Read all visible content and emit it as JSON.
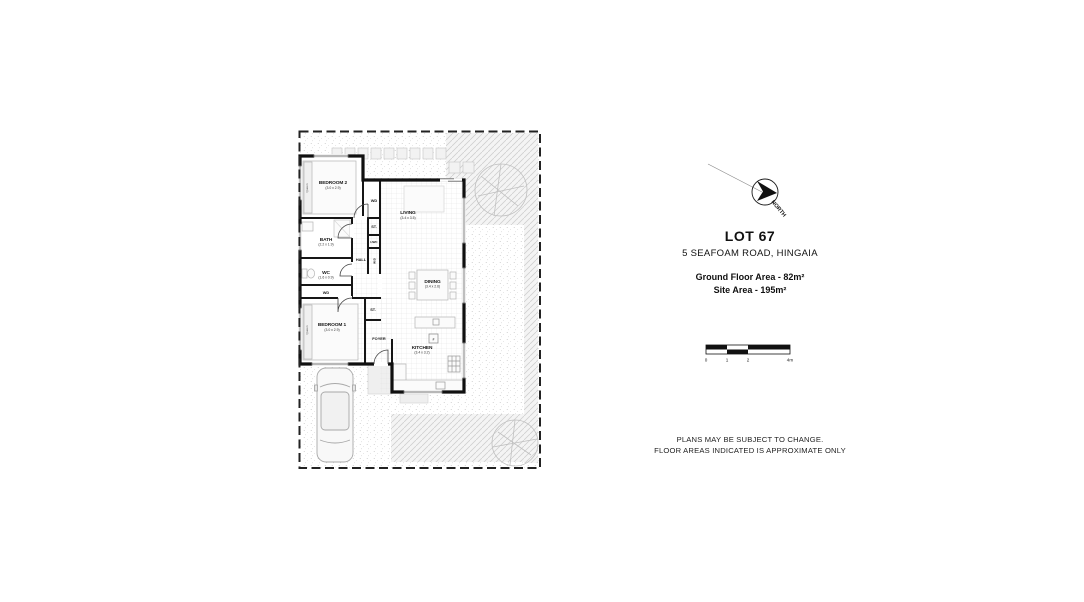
{
  "info_panel": {
    "lot_title": "LOT 67",
    "address": "5 SEAFOAM ROAD, HINGAIA",
    "ground_floor_area": "Ground Floor Area - 82m²",
    "site_area": "Site Area - 195m²",
    "disclaimer_line1": "PLANS MAY BE SUBJECT TO CHANGE.",
    "disclaimer_line2": "FLOOR AREAS INDICATED IS APPROXIMATE ONLY"
  },
  "north_arrow": {
    "label": "NORTH"
  },
  "scale_bar": {
    "t0": "0",
    "t1": "1",
    "t2": "2",
    "t3": "4m"
  },
  "floor_plan": {
    "bedroom2_name": "BEDROOM 2",
    "bedroom2_dims": "(3.0 x 2.9)",
    "bedroom1_name": "BEDROOM 1",
    "bedroom1_dims": "(3.0 x 2.9)",
    "living_name": "LIVING",
    "living_dims": "(3.4 x 3.5)",
    "dining_name": "DINING",
    "dining_dims": "(3.4 x 2.6)",
    "kitchen_name": "KITCHEN",
    "kitchen_dims": "(3.4 x 3.2)",
    "bath_name": "BATH",
    "bath_dims": "(2.2 x 1.9)",
    "wc_name": "WC",
    "wc_dims": "(1.6 x 0.9)",
    "hall_name": "HALL",
    "foyer_name": "FOYER",
    "wardrobe_top": "WD",
    "wardrobe_mid": "WD",
    "store_top": "ST.",
    "store_foyer": "ST.",
    "hwc": "HWC",
    "laundry": "W/D",
    "bed2_tag": "Queen",
    "bed1_tag": "Queen",
    "fridge": "F"
  },
  "colors": {
    "line": "#111111",
    "texture": "#cccccc",
    "boundary": "#222222"
  }
}
